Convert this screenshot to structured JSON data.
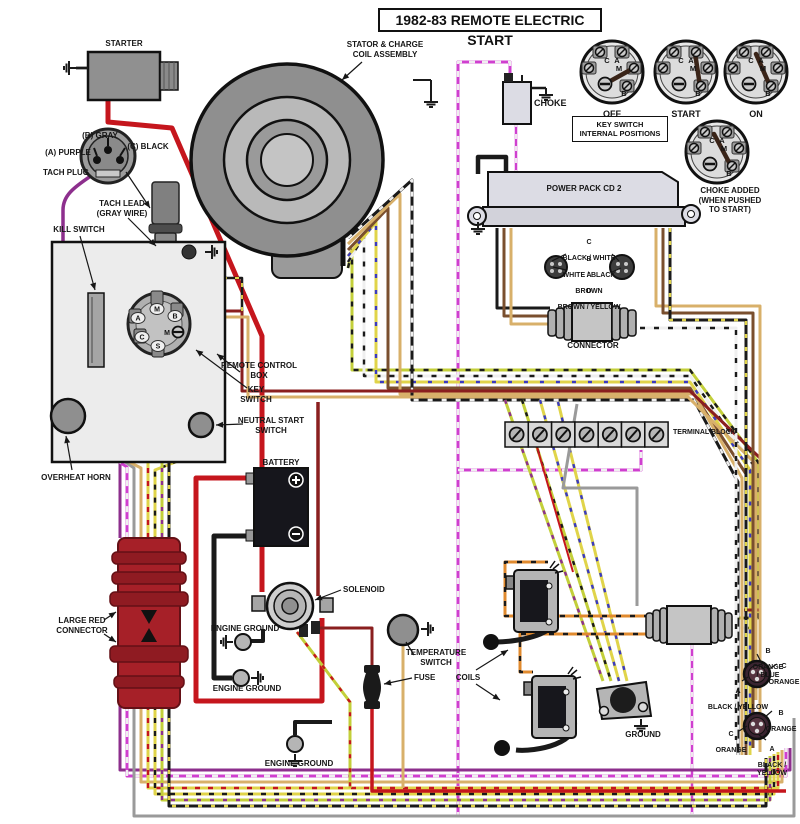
{
  "title": "1982-83 REMOTE ELECTRIC START",
  "colors": {
    "red": "#c5161d",
    "dark_red": "#8a1f1f",
    "black": "#1a1a1a",
    "purple": "#8d2f8d",
    "magenta": "#cf3fcf",
    "gray": "#9a9a9a",
    "tan": "#d8b06a",
    "brown": "#7a4f2e",
    "yellow": "#e0d44a",
    "chartreuse": "#c3cf3a",
    "orange": "#e08a2e",
    "white": "#efefef",
    "blue": "#3a3ac0",
    "large_connector_red": "#a62028"
  },
  "components": {
    "starter": {
      "label": "STARTER"
    },
    "stator": {
      "label": "STATOR & CHARGE\nCOIL ASSEMBLY"
    },
    "choke": {
      "label": "CHOKE"
    },
    "key_switch_dials": {
      "positions": [
        "OFF",
        "START",
        "ON"
      ],
      "letters": [
        "C",
        "A",
        "M",
        "B"
      ],
      "internal_box": "KEY SWITCH\nINTERNAL POSITIONS",
      "choke_added": "CHOKE ADDED\n(WHEN PUSHED\nTO START)"
    },
    "power_pack": {
      "label": "POWER PACK CD 2"
    },
    "pack_connector": {
      "label": "CONNECTOR",
      "pins": [
        {
          "id": "C",
          "wire": "BLACK / WHITE"
        },
        {
          "id": "B",
          "wire": "WHITE / BLACK"
        },
        {
          "id": "A",
          "wire": "BROWN"
        },
        {
          "id": "D",
          "wire": "BROWN / YELLOW"
        }
      ]
    },
    "tach_plug": {
      "label": "TACH PLUG",
      "pins": [
        "(A)  PURPLE",
        "(B) GRAY",
        "(C)  BLACK"
      ],
      "lead": "TACH LEAD\n(GRAY WIRE)"
    },
    "remote_box": {
      "label": "REMOTE CONTROL\nBOX",
      "kill_switch": "KILL SWITCH",
      "key_switch": "KEY\nSWITCH",
      "neutral": "NEUTRAL START\nSWITCH",
      "letters": [
        "M",
        "B",
        "A",
        "C",
        "S",
        "M"
      ]
    },
    "overheat_horn": "OVERHEAT HORN",
    "battery": {
      "label": "BATTERY"
    },
    "large_red_connector": "LARGE RED\nCONNECTOR",
    "solenoid": "SOLENOID",
    "engine_ground": "ENGINE GROUND",
    "temperature_switch": "TEMPERATURE\nSWITCH",
    "fuse": "FUSE",
    "coils": "COILS",
    "ground": "GROUND",
    "terminal_block": "TERMINAL BLOCK",
    "plugs": [
      {
        "pins": [
          {
            "id": "B",
            "wire": "ORANGE / BLUE"
          },
          {
            "id": "C",
            "wire": "ORANGE"
          },
          {
            "id": "A",
            "wire": "BLACK / YELLOW"
          }
        ]
      },
      {
        "pins": [
          {
            "id": "B",
            "wire": "ORANGE"
          },
          {
            "id": "C",
            "wire": "ORANGE"
          },
          {
            "id": "A",
            "wire": "BLACK / YELLOW"
          }
        ]
      }
    ]
  }
}
